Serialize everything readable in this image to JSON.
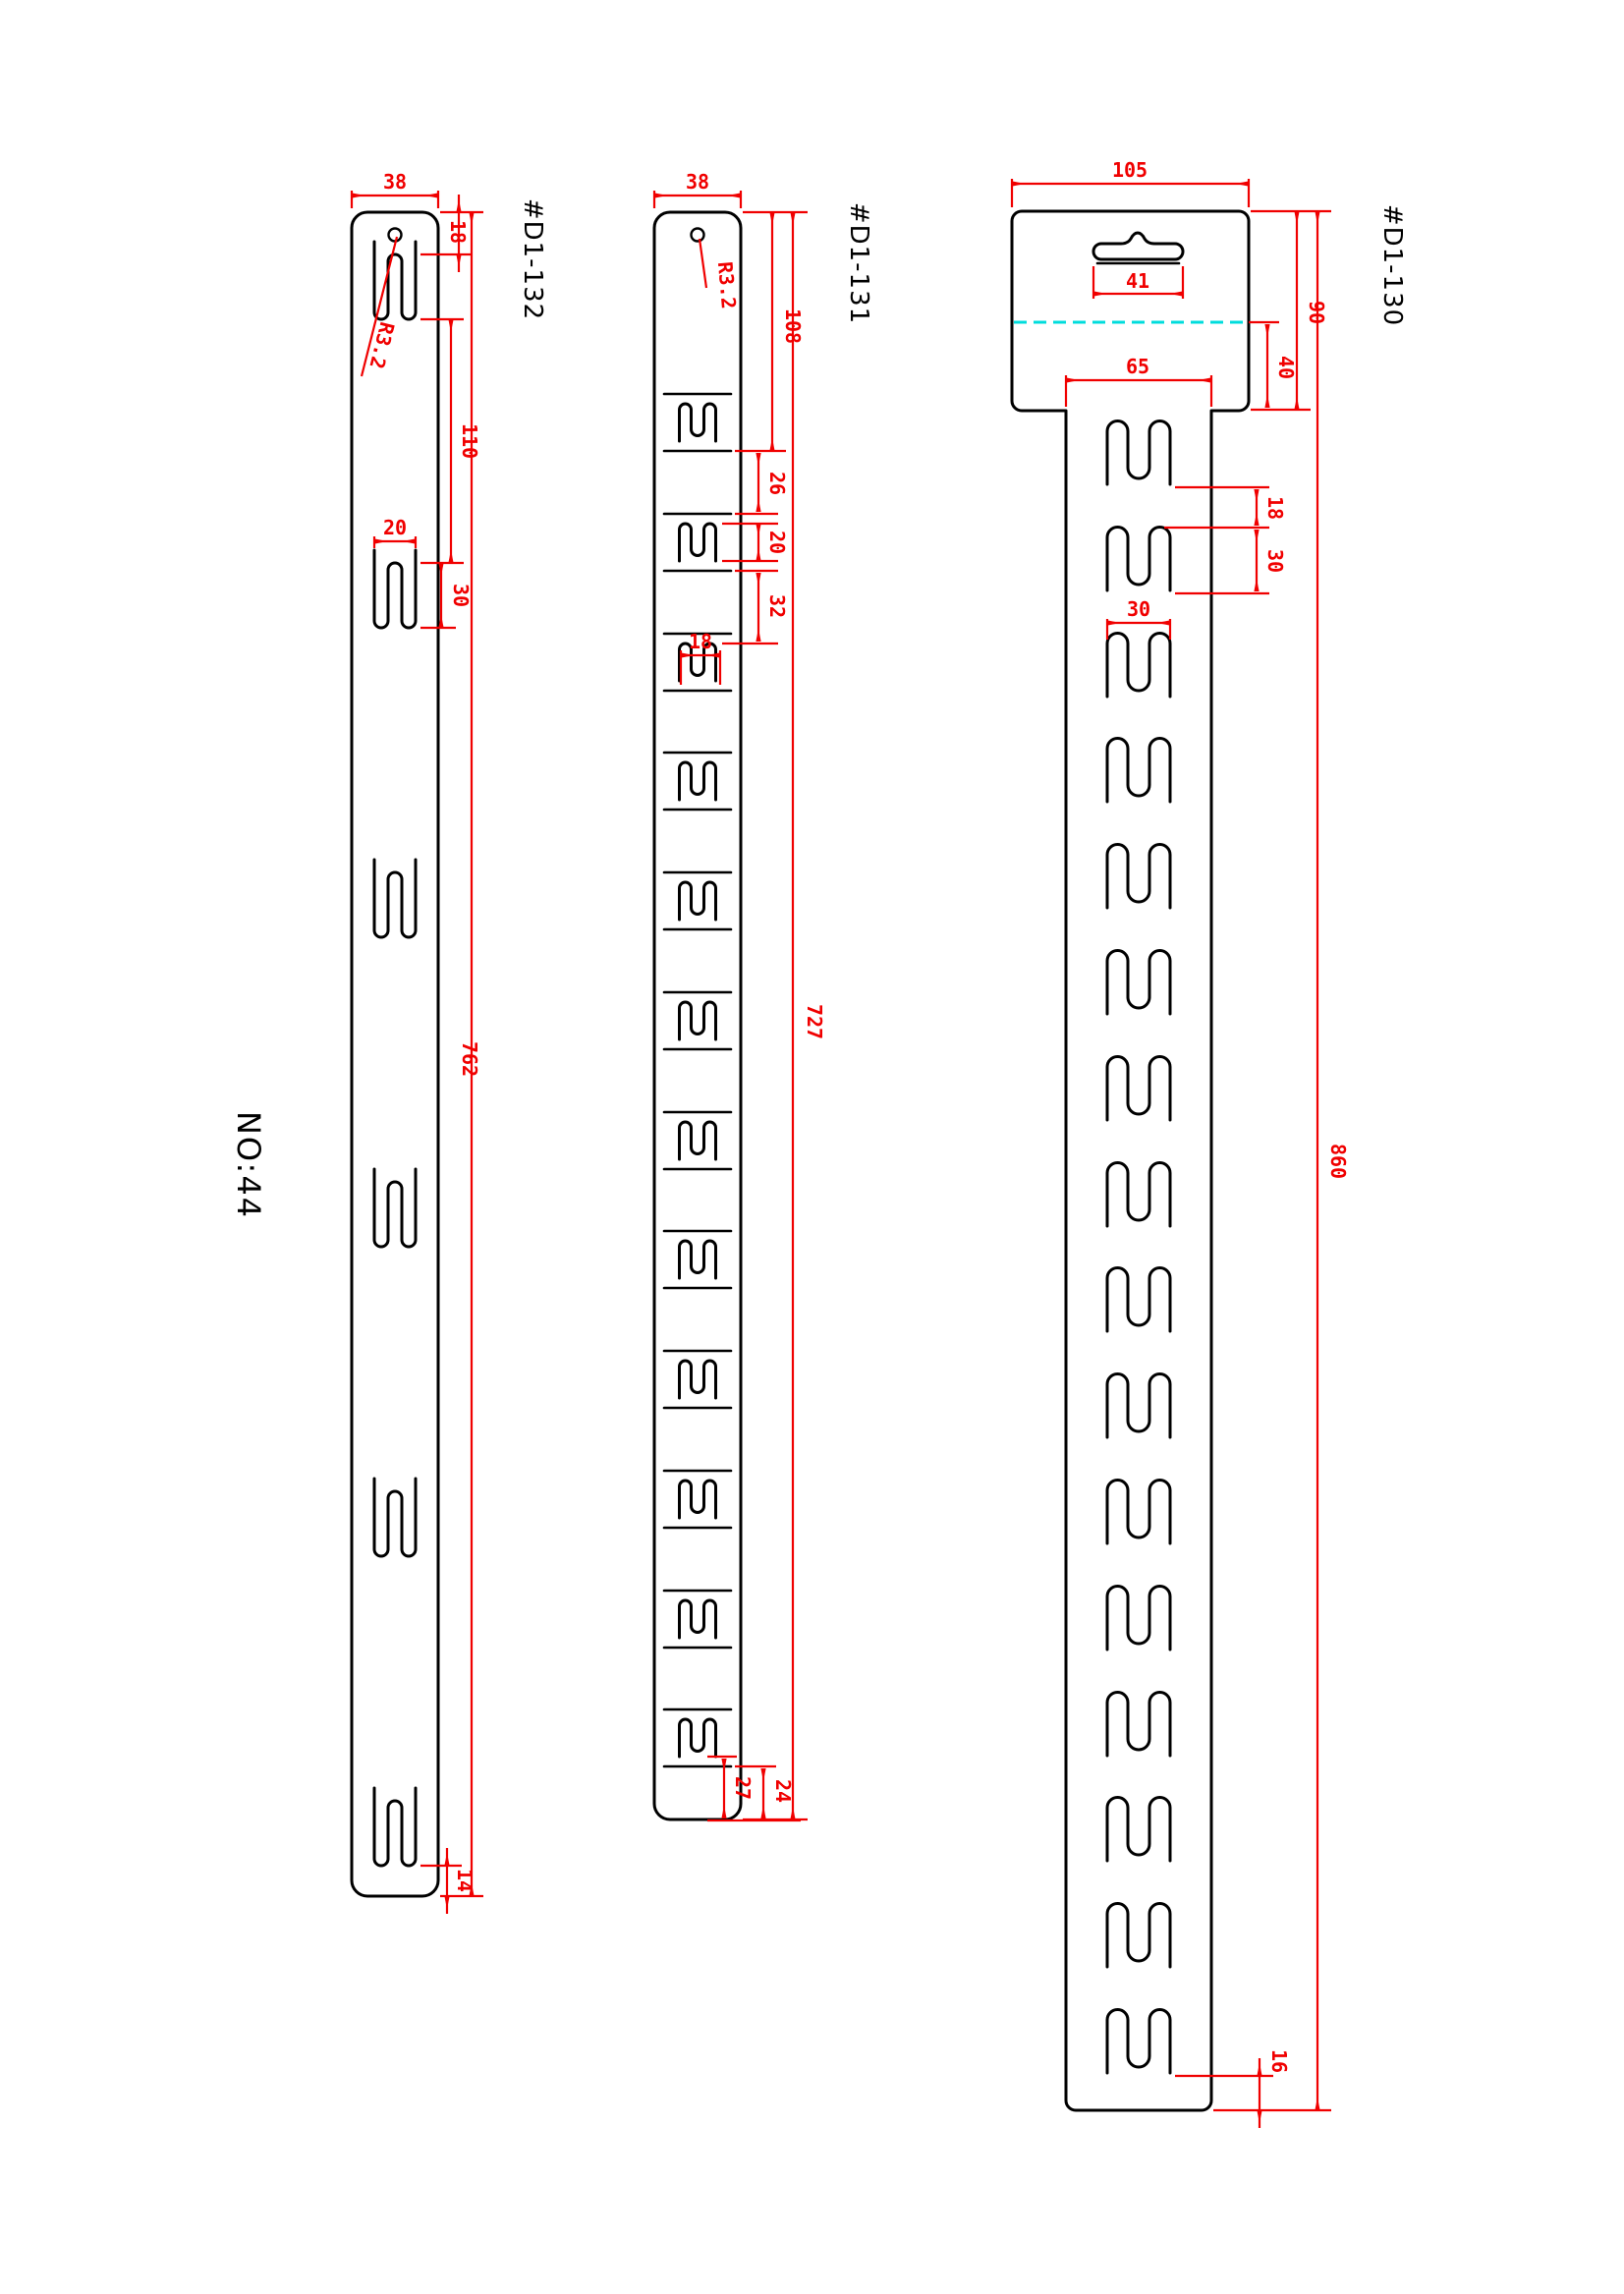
{
  "note_number": "NO:44",
  "colors": {
    "outline": "#000000",
    "dimension": "#f00000",
    "fold_line": "#00dcdc",
    "background": "#ffffff"
  },
  "parts": {
    "d132": {
      "label": "#D1-132",
      "dims": {
        "width": "38",
        "top_offset": "18",
        "hole_radius": "R3.2",
        "slot_gap": "110",
        "slot_width": "20",
        "slot_height": "30",
        "length": "762",
        "bottom_offset": "14"
      }
    },
    "d131": {
      "label": "#D1-131",
      "dims": {
        "width": "38",
        "hole_radius": "R3.2",
        "top_offset": "108",
        "unit_gap": "26",
        "slot_height": "20",
        "unit_pitch": "32",
        "slot_width": "18",
        "length": "727",
        "bottom_offset_slot": "27",
        "bottom_offset_line": "24"
      }
    },
    "d130": {
      "label": "#D1-130",
      "dims": {
        "header_width": "105",
        "hanger_width": "41",
        "header_height": "90",
        "fold_offset": "40",
        "body_width": "65",
        "slot_gap": "18",
        "slot_height": "30",
        "slot_width": "30",
        "length": "860",
        "bottom_offset": "16"
      }
    }
  }
}
